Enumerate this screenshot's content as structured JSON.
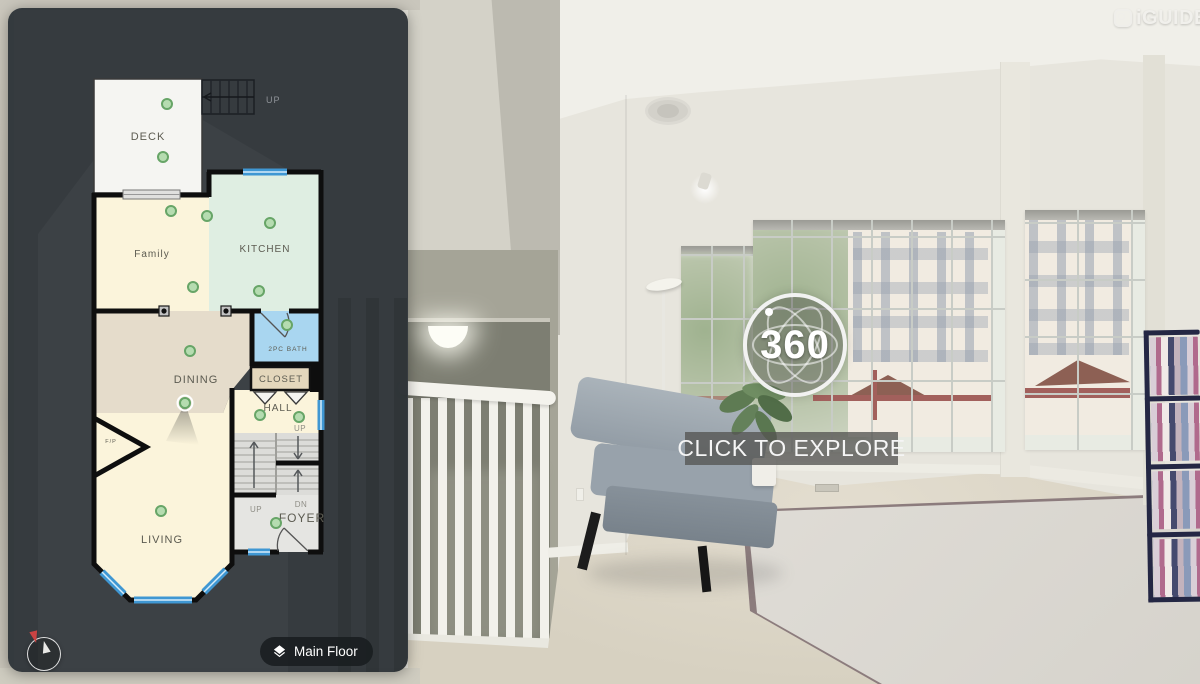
{
  "brand": {
    "logo_text": "iGUIDE"
  },
  "viewer": {
    "badge_text": "360",
    "cta_text": "CLICK TO EXPLORE"
  },
  "floorplan": {
    "rooms": {
      "deck": "DECK",
      "family": "Family",
      "kitchen": "KITCHEN",
      "dining": "DINING",
      "bath": "2PC BATH",
      "closet": "CLOSET",
      "hall": "HALL",
      "living": "LIVING",
      "foyer": "FOYER"
    },
    "labels": {
      "fireplace": "F/P",
      "stairs_top_up": "UP",
      "hall_up": "UP",
      "stairs_up": "UP",
      "stairs_dn": "DN"
    },
    "floor_selector_label": "Main Floor"
  },
  "colors": {
    "panel_bg": "#2F3539",
    "window_accent": "#3F97D3",
    "pano_dot_fill": "#B5DCB0",
    "pano_dot_stroke": "#67A567",
    "room_cream": "#FBF4DB",
    "room_mint": "#DFEEE2",
    "room_tan": "#E5DCCB",
    "room_blue": "#A9D6F0",
    "cta_bg": "#545452"
  }
}
